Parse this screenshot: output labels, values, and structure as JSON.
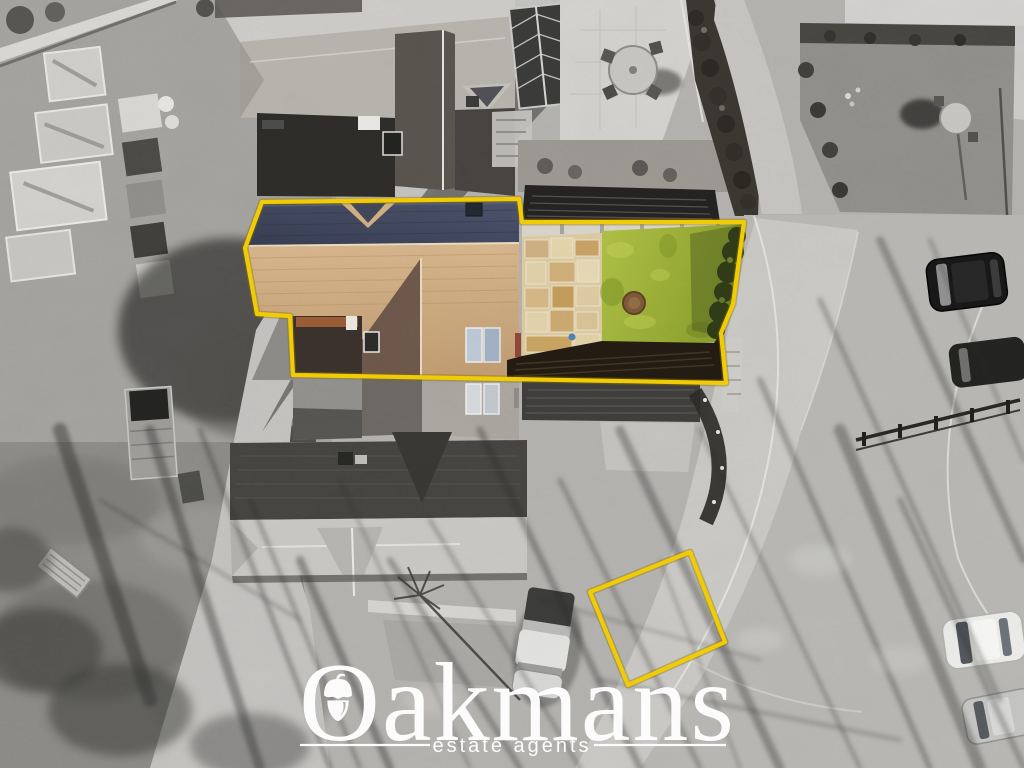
{
  "watermark": {
    "brand": "Oakmans",
    "tagline": "estate agents"
  },
  "logo": {
    "icon": "acorn-icon"
  },
  "colors": {
    "boundary_yellow": "#f0cb06",
    "lawn_light": "#adc044",
    "lawn_dark": "#879c2a",
    "roof_slate_light": "#4a5169",
    "roof_slate_dark": "#353b4f",
    "roof_tile_light": "#d7b48a",
    "roof_tile_dark": "#bf9a6e",
    "patio_sandstone": "#dccaa0",
    "hedge_green": "#2e3a16",
    "fence_shadow": "#221b11",
    "watermark_white": "#ffffff"
  }
}
